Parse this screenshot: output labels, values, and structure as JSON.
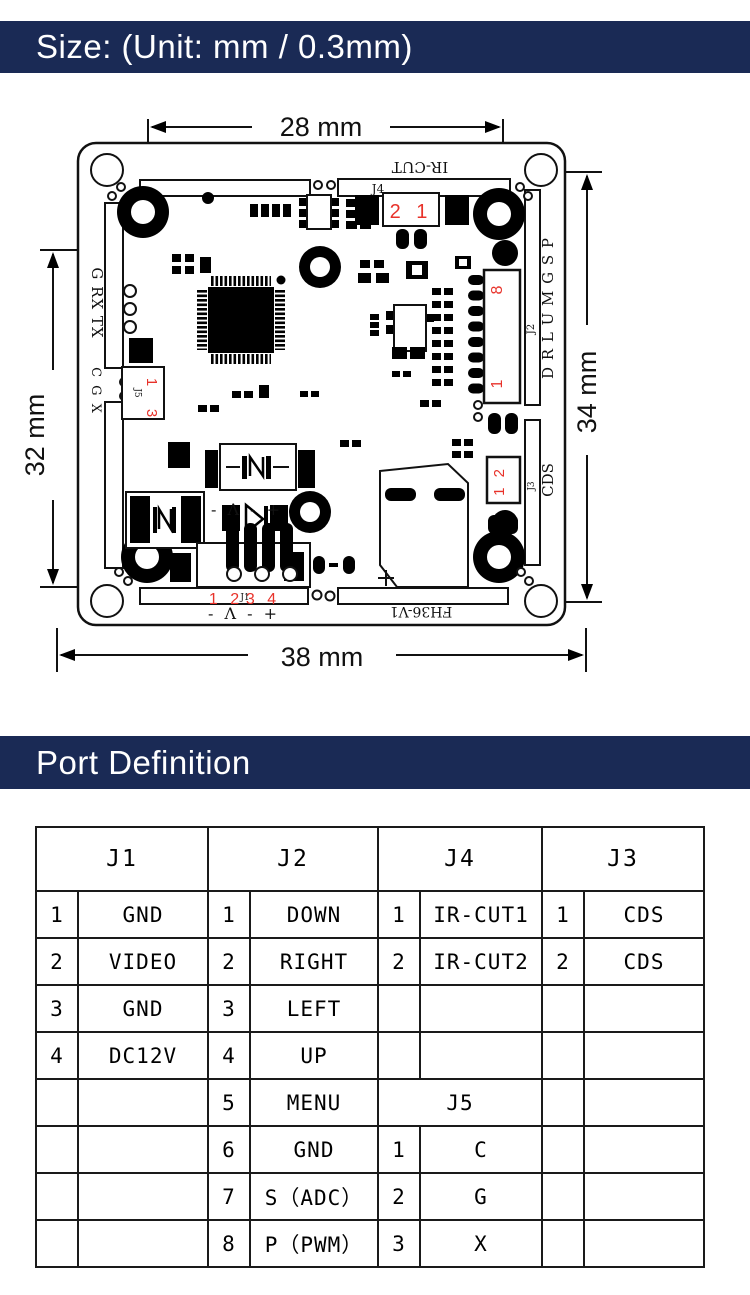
{
  "colors": {
    "navy": "#1a2a55",
    "red": "#e8322a",
    "line": "#111111"
  },
  "size_section": {
    "title": "Size: (Unit: mm / 0.3mm)"
  },
  "port_section": {
    "title": "Port Definition"
  },
  "pcb": {
    "dimensions": {
      "top": "28 mm",
      "left": "32 mm",
      "right": "34 mm",
      "bottom": "38 mm"
    },
    "silkscreen": {
      "ircut": "IR-CUT",
      "j4": "J4",
      "j4_pins": "2 1",
      "uart": "G RX TX",
      "cgx": "C G X",
      "j5": "J5",
      "j5_pin_top": "1",
      "j5_pin_bottom": "3",
      "osd_pins": "D R L U M G S P",
      "j2": "J2",
      "j2_pin_top": "8",
      "j2_pin_bottom": "1",
      "cds": "CDS",
      "j3": "J3",
      "j3_pins": "1 2",
      "j1": "J1",
      "j1_pins_left": "1 2",
      "j1_pins_right": "3 4",
      "polarity_upper": "- Λ - +",
      "polarity_lower": "- Λ - +",
      "board_name": "FH36-V1"
    }
  },
  "port_table": {
    "groups": [
      "J1",
      "J2",
      "J4",
      "J3"
    ],
    "rows": [
      [
        "1",
        "GND",
        "1",
        "DOWN",
        "1",
        "IR-CUT1",
        "1",
        "CDS"
      ],
      [
        "2",
        "VIDEO",
        "2",
        "RIGHT",
        "2",
        "IR-CUT2",
        "2",
        "CDS"
      ],
      [
        "3",
        "GND",
        "3",
        "LEFT",
        "",
        "",
        "",
        ""
      ],
      [
        "4",
        "DC12V",
        "4",
        "UP",
        "",
        "",
        "",
        ""
      ],
      [
        "",
        "",
        "5",
        "MENU",
        "J5",
        "",
        "",
        ""
      ],
      [
        "",
        "",
        "6",
        "GND",
        "1",
        "C",
        "",
        ""
      ],
      [
        "",
        "",
        "7",
        "S（ADC）",
        "2",
        "G",
        "",
        ""
      ],
      [
        "",
        "",
        "8",
        "P（PWM）",
        "3",
        "X",
        "",
        ""
      ]
    ]
  }
}
